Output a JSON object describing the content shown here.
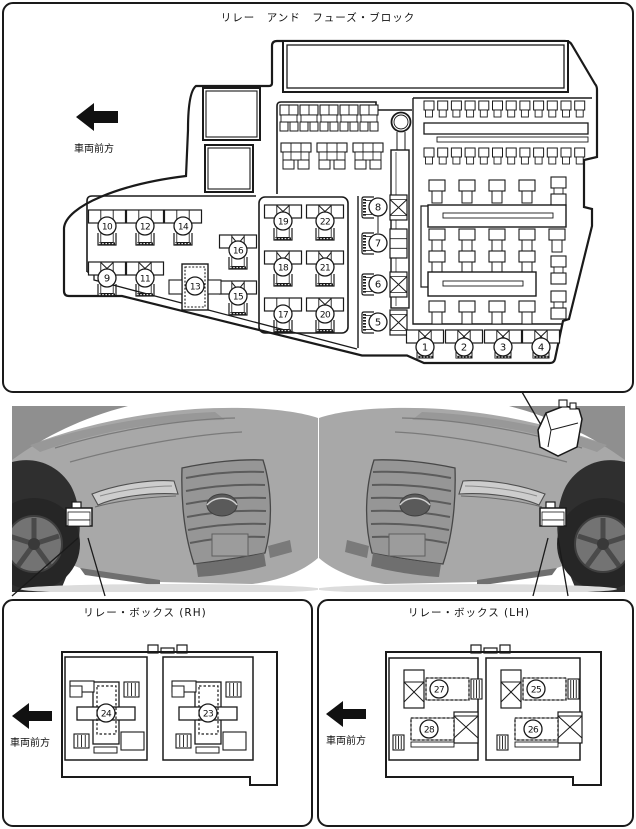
{
  "colors": {
    "line": "#1a1a1a",
    "car_body": "#a8a8a8",
    "car_dark": "#6f6f6f",
    "car_grille": "#969696",
    "wheel": "#262626"
  },
  "top_panel": {
    "title": "リレー　アンド　フューズ・ブロック",
    "front_label": "車両前方",
    "bank_callouts": [
      {
        "n": "10",
        "cx": 107,
        "bar_y": 210,
        "mid": "plain",
        "cy": 226,
        "bracket_y": 233
      },
      {
        "n": "12",
        "cx": 145,
        "bar_y": 210,
        "mid": "plain",
        "cy": 226,
        "bracket_y": 233
      },
      {
        "n": "14",
        "cx": 183,
        "bar_y": 210,
        "mid": "plain",
        "cy": 226,
        "bracket_y": 233
      },
      {
        "n": "9",
        "cx": 107,
        "bar_y": 262,
        "mid": "x",
        "cy": 278,
        "bracket_y": 284
      },
      {
        "n": "11",
        "cx": 145,
        "bar_y": 262,
        "mid": "x",
        "cy": 278,
        "bracket_y": 284
      },
      {
        "n": "16",
        "cx": 238,
        "bar_y": 235,
        "mid": "m",
        "cy": 250,
        "bracket_y": 257
      },
      {
        "n": "15",
        "cx": 238,
        "bar_y": 281,
        "mid": "m",
        "cy": 296,
        "bracket_y": 303
      },
      {
        "n": "19",
        "cx": 283,
        "bar_y": 205,
        "mid": "x",
        "cy": 221,
        "bracket_y": 228
      },
      {
        "n": "22",
        "cx": 325,
        "bar_y": 205,
        "mid": "x",
        "cy": 221,
        "bracket_y": 228
      },
      {
        "n": "18",
        "cx": 283,
        "bar_y": 251,
        "mid": "m",
        "cy": 267,
        "bracket_y": 274
      },
      {
        "n": "21",
        "cx": 325,
        "bar_y": 251,
        "mid": "m",
        "cy": 267,
        "bracket_y": 274
      },
      {
        "n": "17",
        "cx": 283,
        "bar_y": 298,
        "mid": "plain",
        "cy": 314,
        "bracket_y": 320
      },
      {
        "n": "20",
        "cx": 325,
        "bar_y": 298,
        "mid": "x",
        "cy": 314,
        "bracket_y": 320
      }
    ],
    "plus_callout": {
      "n": "13",
      "cx": 195,
      "cy": 286
    },
    "side_callouts": [
      {
        "n": "8",
        "cy": 207,
        "box": "x"
      },
      {
        "n": "7",
        "cy": 243,
        "box": "seg"
      },
      {
        "n": "6",
        "cy": 284,
        "box": "x"
      },
      {
        "n": "5",
        "cy": 322,
        "box": "x"
      }
    ],
    "bottom_callouts": [
      {
        "n": "1",
        "cx": 425
      },
      {
        "n": "2",
        "cx": 464
      },
      {
        "n": "3",
        "cx": 503
      },
      {
        "n": "4",
        "cx": 541
      }
    ]
  },
  "rh_panel": {
    "title": "リレー・ボックス (RH)",
    "front_label": "車両前方",
    "callouts": [
      {
        "n": "24",
        "cx": 106,
        "cy": 713
      },
      {
        "n": "23",
        "cx": 208,
        "cy": 713
      }
    ]
  },
  "lh_panel": {
    "title": "リレー・ボックス (LH)",
    "front_label": "車両前方",
    "callouts": [
      {
        "n": "27",
        "cx": 439,
        "cy": 689,
        "pos": "top"
      },
      {
        "n": "25",
        "cx": 536,
        "cy": 689,
        "pos": "top"
      },
      {
        "n": "28",
        "cx": 429,
        "cy": 729,
        "pos": "bot"
      },
      {
        "n": "26",
        "cx": 533,
        "cy": 729,
        "pos": "bot"
      }
    ]
  }
}
